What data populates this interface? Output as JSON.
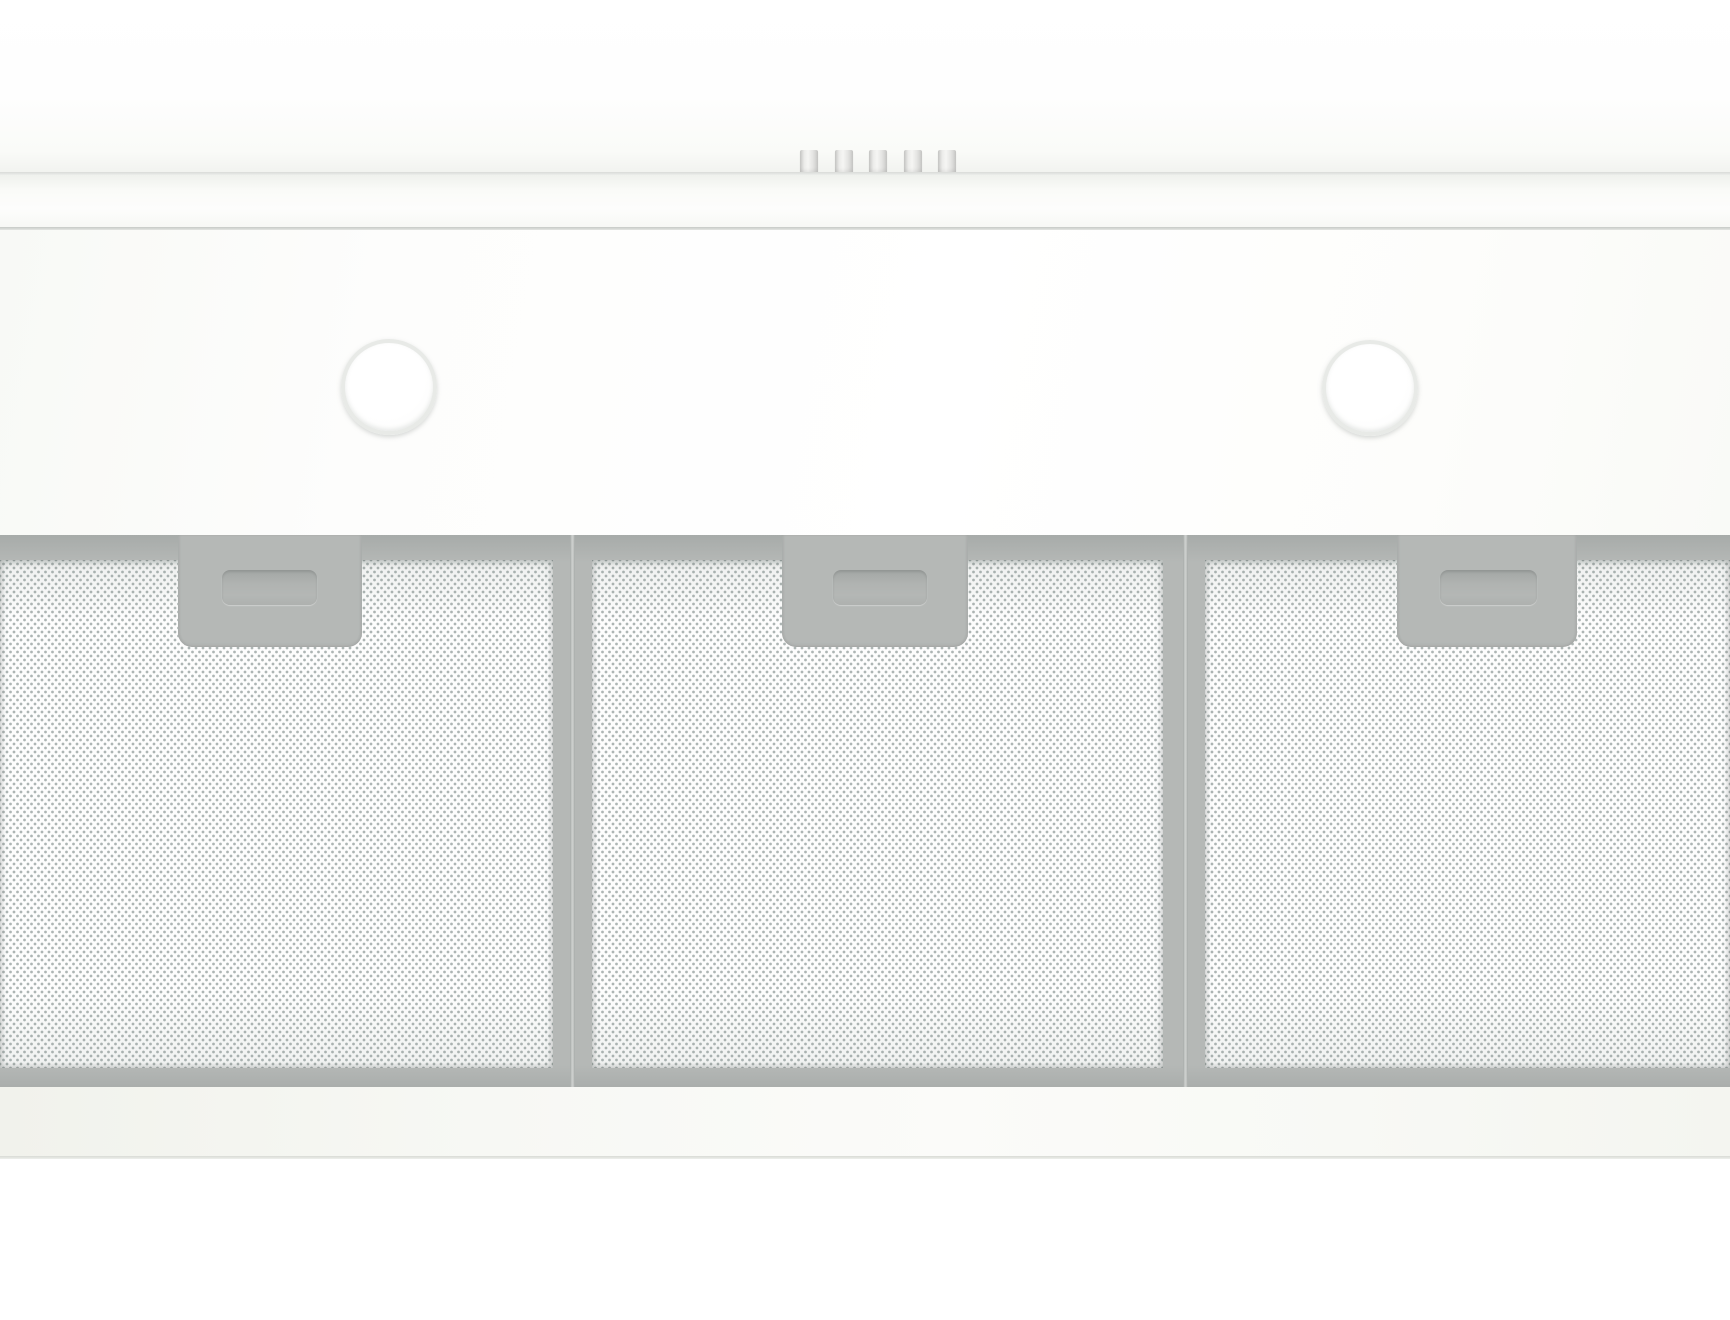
{
  "scene": {
    "subject": "white under-cabinet range hood, front bottom view",
    "text_visible": "",
    "part_counts": {
      "control_buttons": 5,
      "lamps": 2,
      "mesh_filters": 3
    }
  },
  "colors": {
    "seam_line": "#d9dbd8",
    "trim_line": "#c6c9c6",
    "frame_gray": "#b5b8b6",
    "frame_gray_dark": "#a7aba9",
    "handle_gray": "#b0b3b1",
    "seam_light": "#cbcecc",
    "mesh_base": "#fdfdfd",
    "lamp_ring": "#e8eae7",
    "lip_edge": "#d8dad5"
  },
  "controls": {
    "buttons": [
      {
        "name": "control-button-1",
        "x": 800
      },
      {
        "name": "control-button-2",
        "x": 835
      },
      {
        "name": "control-button-3",
        "x": 869
      },
      {
        "name": "control-button-4",
        "x": 904
      },
      {
        "name": "control-button-5",
        "x": 938
      }
    ]
  },
  "lamps": [
    {
      "name": "lamp-left",
      "cx": 389,
      "cy": 387,
      "r": 48
    },
    {
      "name": "lamp-right",
      "cx": 1370,
      "cy": 388,
      "r": 48
    }
  ],
  "filters": [
    {
      "name": "mesh-filter-left",
      "mesh_x": 0,
      "mesh_w": 553,
      "recess_x": 178,
      "recess_w": 184,
      "handle_x": 222,
      "handle_w": 95
    },
    {
      "name": "mesh-filter-center",
      "mesh_x": 592,
      "mesh_w": 571,
      "recess_x": 782,
      "recess_w": 186,
      "handle_x": 833,
      "handle_w": 94
    },
    {
      "name": "mesh-filter-right",
      "mesh_x": 1205,
      "mesh_w": 525,
      "recess_x": 1397,
      "recess_w": 180,
      "handle_x": 1440,
      "handle_w": 97
    }
  ],
  "filter_seams": [
    {
      "x": 570
    },
    {
      "x": 1183
    }
  ]
}
